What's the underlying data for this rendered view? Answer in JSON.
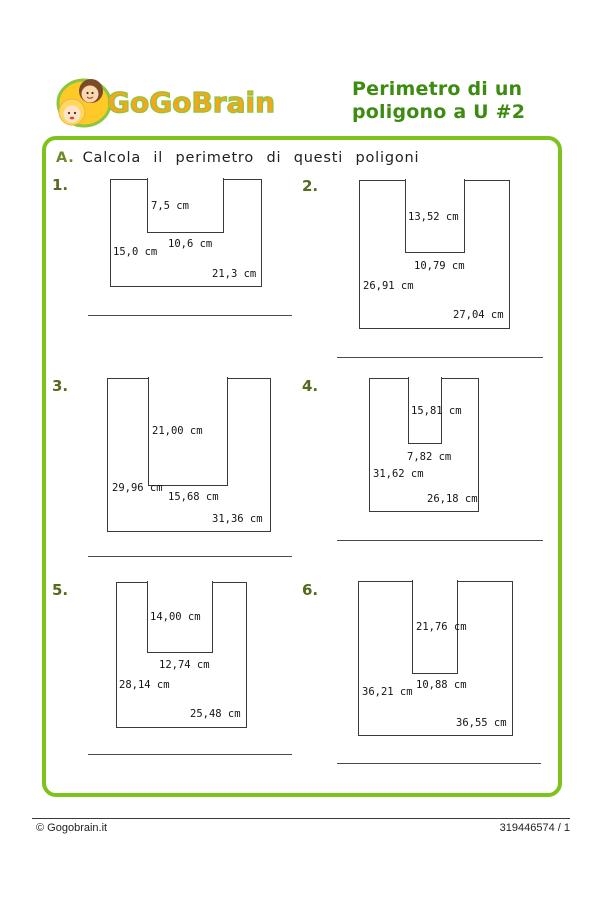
{
  "header": {
    "logo_text": "GoGoBrain",
    "title_line1": "Perimetro di un",
    "title_line2": "poligono a U #2"
  },
  "instruction": {
    "letter": "A.",
    "text": "Calcola il perimetro di questi poligoni"
  },
  "colors": {
    "box_border_green": "#7dc31b",
    "title_green": "#3d8b10",
    "number_olive": "#55691f",
    "logo_orange": "#f9a51a",
    "logo_outline_green": "#8cc63f",
    "shape_line": "#3a3a3a"
  },
  "problems": [
    {
      "number": "1.",
      "number_pos": {
        "x": 52,
        "y": 176
      },
      "rect": {
        "x": 110,
        "y": 179,
        "w": 152,
        "h": 108
      },
      "notch": {
        "offset": 37,
        "w": 77,
        "d": 54
      },
      "labels": [
        {
          "name": "notch-height",
          "text": "7,5 cm",
          "x": 151,
          "y": 200
        },
        {
          "name": "notch-width",
          "text": "10,6 cm",
          "x": 168,
          "y": 238
        },
        {
          "name": "left-side",
          "text": "15,0 cm",
          "x": 113,
          "y": 246
        },
        {
          "name": "bottom-side",
          "text": "21,3 cm",
          "x": 212,
          "y": 268
        }
      ],
      "answer_line": {
        "x": 88,
        "y": 315,
        "w": 204
      }
    },
    {
      "number": "2.",
      "number_pos": {
        "x": 302,
        "y": 177
      },
      "rect": {
        "x": 359,
        "y": 180,
        "w": 151,
        "h": 149
      },
      "notch": {
        "offset": 46,
        "w": 60,
        "d": 73
      },
      "labels": [
        {
          "name": "notch-height",
          "text": "13,52 cm",
          "x": 408,
          "y": 211
        },
        {
          "name": "notch-width",
          "text": "10,79 cm",
          "x": 414,
          "y": 260
        },
        {
          "name": "left-side",
          "text": "26,91 cm",
          "x": 363,
          "y": 280
        },
        {
          "name": "bottom-side",
          "text": "27,04 cm",
          "x": 453,
          "y": 309
        }
      ],
      "answer_line": {
        "x": 337,
        "y": 357,
        "w": 206
      }
    },
    {
      "number": "3.",
      "number_pos": {
        "x": 52,
        "y": 377
      },
      "rect": {
        "x": 107,
        "y": 378,
        "w": 164,
        "h": 154
      },
      "notch": {
        "offset": 41,
        "w": 80,
        "d": 108
      },
      "labels": [
        {
          "name": "notch-height",
          "text": "21,00 cm",
          "x": 152,
          "y": 425
        },
        {
          "name": "left-side",
          "text": "29,96 cm",
          "x": 112,
          "y": 482
        },
        {
          "name": "notch-width",
          "text": "15,68 cm",
          "x": 168,
          "y": 491
        },
        {
          "name": "bottom-side",
          "text": "31,36 cm",
          "x": 212,
          "y": 513
        }
      ],
      "answer_line": {
        "x": 88,
        "y": 556,
        "w": 204
      }
    },
    {
      "number": "4.",
      "number_pos": {
        "x": 302,
        "y": 377
      },
      "rect": {
        "x": 369,
        "y": 378,
        "w": 110,
        "h": 134
      },
      "notch": {
        "offset": 39,
        "w": 34,
        "d": 66
      },
      "labels": [
        {
          "name": "notch-height",
          "text": "15,81 cm",
          "x": 411,
          "y": 405
        },
        {
          "name": "notch-width",
          "text": "7,82 cm",
          "x": 407,
          "y": 451
        },
        {
          "name": "left-side",
          "text": "31,62 cm",
          "x": 373,
          "y": 468
        },
        {
          "name": "bottom-side",
          "text": "26,18 cm",
          "x": 427,
          "y": 493
        }
      ],
      "answer_line": {
        "x": 337,
        "y": 540,
        "w": 206
      }
    },
    {
      "number": "5.",
      "number_pos": {
        "x": 52,
        "y": 581
      },
      "rect": {
        "x": 116,
        "y": 582,
        "w": 131,
        "h": 146
      },
      "notch": {
        "offset": 31,
        "w": 66,
        "d": 71
      },
      "labels": [
        {
          "name": "notch-height",
          "text": "14,00 cm",
          "x": 150,
          "y": 611
        },
        {
          "name": "notch-width",
          "text": "12,74 cm",
          "x": 159,
          "y": 659
        },
        {
          "name": "left-side",
          "text": "28,14 cm",
          "x": 119,
          "y": 679
        },
        {
          "name": "bottom-side",
          "text": "25,48 cm",
          "x": 190,
          "y": 708
        }
      ],
      "answer_line": {
        "x": 88,
        "y": 754,
        "w": 204
      }
    },
    {
      "number": "6.",
      "number_pos": {
        "x": 302,
        "y": 581
      },
      "rect": {
        "x": 358,
        "y": 581,
        "w": 155,
        "h": 155
      },
      "notch": {
        "offset": 54,
        "w": 46,
        "d": 93
      },
      "labels": [
        {
          "name": "notch-height",
          "text": "21,76 cm",
          "x": 416,
          "y": 621
        },
        {
          "name": "notch-width",
          "text": "10,88 cm",
          "x": 416,
          "y": 679
        },
        {
          "name": "left-side",
          "text": "36,21 cm",
          "x": 362,
          "y": 686
        },
        {
          "name": "bottom-side",
          "text": "36,55 cm",
          "x": 456,
          "y": 717
        }
      ],
      "answer_line": {
        "x": 337,
        "y": 763,
        "w": 204
      }
    }
  ],
  "footer": {
    "copyright": "© Gogobrain.it",
    "page_ref": "319446574 / 1"
  }
}
